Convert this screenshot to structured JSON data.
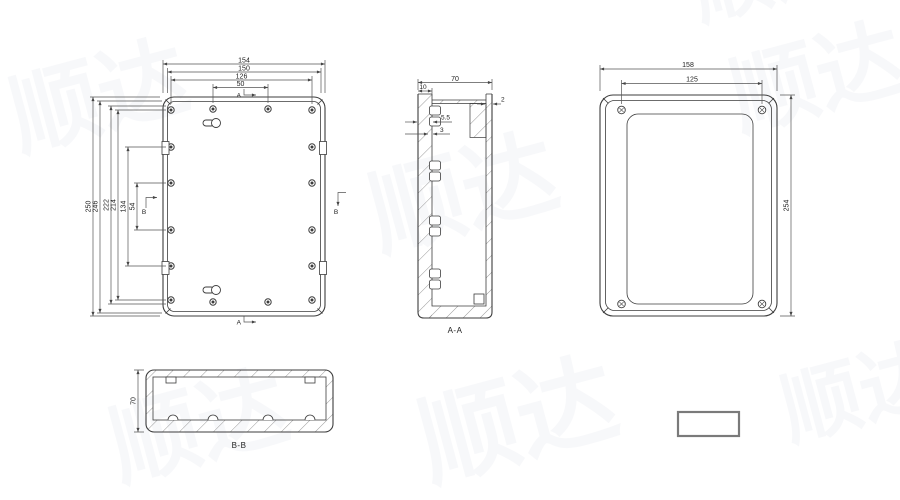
{
  "watermark": {
    "text": "顺达"
  },
  "front": {
    "d154": "154",
    "d150": "150",
    "d126": "126",
    "d50": "50",
    "d250": "250",
    "d246": "246",
    "d222": "222",
    "d214": "214",
    "d134": "134",
    "d54": "54",
    "arrow_a": "A",
    "arrow_b": "B"
  },
  "section_aa": {
    "d70": "70",
    "d10": "10",
    "d55": "5.5",
    "d3": "3",
    "d2": "2",
    "label": "A-A"
  },
  "back": {
    "d158": "158",
    "d125": "125",
    "d254": "254"
  },
  "section_bb": {
    "d70": "70",
    "label": "B-B"
  }
}
